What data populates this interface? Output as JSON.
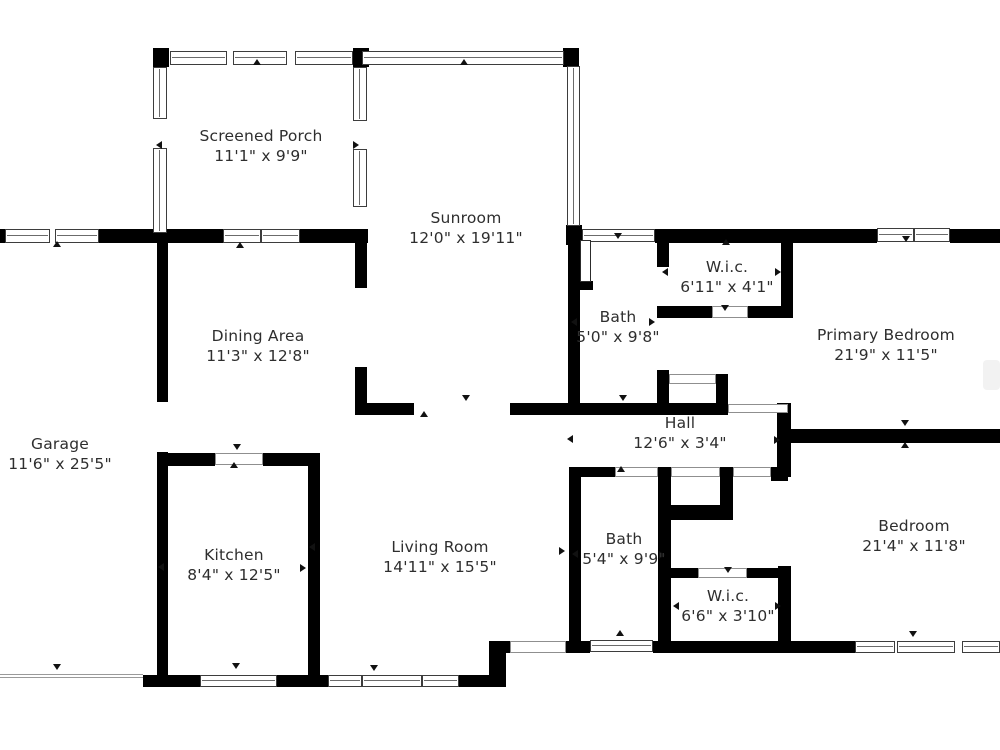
{
  "title": "Floor Plan",
  "colors": {
    "background": "#ffffff",
    "wall": "#000000",
    "window_border": "#3d3d3d",
    "window_line": "#6b6b6b",
    "door_line": "#8f8f8f",
    "label_text": "#2e2e2e",
    "marker": "#111111"
  },
  "rooms": [
    {
      "name": "Screened Porch",
      "dims": "11'1\" x 9'9\"",
      "cx": 261,
      "cy": 146
    },
    {
      "name": "Sunroom",
      "dims": "12'0\" x 19'11\"",
      "cx": 466,
      "cy": 228
    },
    {
      "name": "Dining Area",
      "dims": "11'3\" x 12'8\"",
      "cx": 258,
      "cy": 346
    },
    {
      "name": "Garage",
      "dims": "11'6\" x 25'5\"",
      "cx": 60,
      "cy": 454
    },
    {
      "name": "Kitchen",
      "dims": "8'4\" x 12'5\"",
      "cx": 234,
      "cy": 565
    },
    {
      "name": "Living Room",
      "dims": "14'11\" x 15'5\"",
      "cx": 440,
      "cy": 557
    },
    {
      "name": "Bath",
      "dims": "5'0\" x 9'8\"",
      "cx": 618,
      "cy": 327
    },
    {
      "name": "W.i.c.",
      "dims": "6'11\" x 4'1\"",
      "cx": 727,
      "cy": 277
    },
    {
      "name": "Primary Bedroom",
      "dims": "21'9\" x 11'5\"",
      "cx": 886,
      "cy": 345
    },
    {
      "name": "Hall",
      "dims": "12'6\" x 3'4\"",
      "cx": 680,
      "cy": 433
    },
    {
      "name": "Bath",
      "dims": "5'4\" x 9'9\"",
      "cx": 624,
      "cy": 549
    },
    {
      "name": "W.i.c.",
      "dims": "6'6\" x 3'10\"",
      "cx": 728,
      "cy": 606
    },
    {
      "name": "Bedroom",
      "dims": "21'4\" x 11'8\"",
      "cx": 914,
      "cy": 536
    }
  ],
  "plan": {
    "walls": [
      [
        0,
        229,
        6,
        14
      ],
      [
        99,
        229,
        124,
        14
      ],
      [
        300,
        229,
        68,
        14
      ],
      [
        153,
        48,
        16,
        19
      ],
      [
        353,
        48,
        16,
        19
      ],
      [
        563,
        48,
        16,
        19
      ],
      [
        566,
        225,
        16,
        20
      ],
      [
        655,
        229,
        222,
        14
      ],
      [
        950,
        229,
        50,
        14
      ],
      [
        568,
        238,
        12,
        177
      ],
      [
        568,
        281,
        25,
        9
      ],
      [
        355,
        243,
        12,
        45
      ],
      [
        355,
        367,
        12,
        48
      ],
      [
        355,
        403,
        59,
        12
      ],
      [
        510,
        403,
        218,
        12
      ],
      [
        657,
        243,
        12,
        24
      ],
      [
        657,
        306,
        55,
        12
      ],
      [
        748,
        306,
        45,
        12
      ],
      [
        781,
        231,
        12,
        87
      ],
      [
        657,
        370,
        12,
        38
      ],
      [
        716,
        374,
        12,
        34
      ],
      [
        777,
        403,
        14,
        74
      ],
      [
        791,
        429,
        17,
        14
      ],
      [
        788,
        429,
        212,
        14
      ],
      [
        569,
        467,
        46,
        10
      ],
      [
        771,
        467,
        17,
        14
      ],
      [
        720,
        467,
        13,
        40
      ],
      [
        671,
        505,
        62,
        15
      ],
      [
        569,
        467,
        12,
        185
      ],
      [
        658,
        467,
        13,
        185
      ],
      [
        671,
        568,
        27,
        10
      ],
      [
        747,
        568,
        43,
        10
      ],
      [
        778,
        566,
        13,
        87
      ],
      [
        566,
        641,
        24,
        12
      ],
      [
        653,
        641,
        202,
        12
      ],
      [
        489,
        641,
        17,
        46
      ],
      [
        506,
        641,
        6,
        12
      ],
      [
        143,
        675,
        57,
        12
      ],
      [
        277,
        675,
        51,
        12
      ],
      [
        458,
        675,
        31,
        12
      ],
      [
        157,
        240,
        11,
        162
      ],
      [
        157,
        452,
        11,
        235
      ],
      [
        157,
        453,
        58,
        13
      ],
      [
        263,
        453,
        57,
        13
      ],
      [
        308,
        453,
        12,
        234
      ]
    ],
    "windows": [
      {
        "x": 5,
        "y": 229,
        "w": 45,
        "h": 14,
        "o": "h"
      },
      {
        "x": 55,
        "y": 229,
        "w": 44,
        "h": 14,
        "o": "h"
      },
      {
        "x": 223,
        "y": 229,
        "w": 38,
        "h": 14,
        "o": "h"
      },
      {
        "x": 261,
        "y": 229,
        "w": 39,
        "h": 14,
        "o": "h"
      },
      {
        "x": 170,
        "y": 51,
        "w": 57,
        "h": 14,
        "o": "h"
      },
      {
        "x": 233,
        "y": 51,
        "w": 54,
        "h": 14,
        "o": "h"
      },
      {
        "x": 295,
        "y": 51,
        "w": 58,
        "h": 14,
        "o": "h"
      },
      {
        "x": 362,
        "y": 51,
        "w": 202,
        "h": 14,
        "o": "h"
      },
      {
        "x": 582,
        "y": 229,
        "w": 73,
        "h": 13,
        "o": "h"
      },
      {
        "x": 877,
        "y": 228,
        "w": 37,
        "h": 14,
        "o": "h"
      },
      {
        "x": 914,
        "y": 228,
        "w": 36,
        "h": 14,
        "o": "h"
      },
      {
        "x": 590,
        "y": 640,
        "w": 63,
        "h": 12,
        "o": "h"
      },
      {
        "x": 855,
        "y": 641,
        "w": 40,
        "h": 12,
        "o": "h"
      },
      {
        "x": 897,
        "y": 641,
        "w": 58,
        "h": 12,
        "o": "h"
      },
      {
        "x": 962,
        "y": 641,
        "w": 38,
        "h": 12,
        "o": "h"
      },
      {
        "x": 200,
        "y": 675,
        "w": 77,
        "h": 12,
        "o": "h"
      },
      {
        "x": 328,
        "y": 675,
        "w": 34,
        "h": 12,
        "o": "h"
      },
      {
        "x": 362,
        "y": 675,
        "w": 60,
        "h": 12,
        "o": "h"
      },
      {
        "x": 422,
        "y": 675,
        "w": 37,
        "h": 12,
        "o": "h"
      },
      {
        "x": 153,
        "y": 67,
        "w": 14,
        "h": 52,
        "o": "v"
      },
      {
        "x": 153,
        "y": 148,
        "w": 14,
        "h": 85,
        "o": "v"
      },
      {
        "x": 353,
        "y": 67,
        "w": 14,
        "h": 54,
        "o": "v"
      },
      {
        "x": 353,
        "y": 149,
        "w": 14,
        "h": 58,
        "o": "v"
      },
      {
        "x": 567,
        "y": 66,
        "w": 13,
        "h": 160,
        "o": "v"
      }
    ],
    "doors": [
      {
        "x": 215,
        "y": 453,
        "w": 48,
        "h": 12,
        "t": "door"
      },
      {
        "x": 157,
        "y": 402,
        "w": 11,
        "h": 50,
        "t": "open"
      },
      {
        "x": 414,
        "y": 404,
        "w": 96,
        "h": 10,
        "t": "open"
      },
      {
        "x": 728,
        "y": 404,
        "w": 60,
        "h": 9,
        "t": "door"
      },
      {
        "x": 615,
        "y": 467,
        "w": 43,
        "h": 10,
        "t": "door"
      },
      {
        "x": 671,
        "y": 467,
        "w": 49,
        "h": 10,
        "t": "door"
      },
      {
        "x": 733,
        "y": 467,
        "w": 38,
        "h": 10,
        "t": "door"
      },
      {
        "x": 712,
        "y": 306,
        "w": 36,
        "h": 12,
        "t": "door"
      },
      {
        "x": 657,
        "y": 267,
        "w": 12,
        "h": 39,
        "t": "open"
      },
      {
        "x": 698,
        "y": 568,
        "w": 49,
        "h": 10,
        "t": "door"
      },
      {
        "x": 510,
        "y": 641,
        "w": 56,
        "h": 12,
        "t": "door"
      },
      {
        "x": 355,
        "y": 288,
        "w": 12,
        "h": 79,
        "t": "open"
      },
      {
        "x": 669,
        "y": 374,
        "w": 47,
        "h": 10,
        "t": "door"
      }
    ],
    "leaves": [
      {
        "x": 580,
        "y": 240,
        "w": 11,
        "h": 42
      }
    ],
    "markers": [
      {
        "x": 57,
        "y": 245,
        "d": "up"
      },
      {
        "x": 240,
        "y": 246,
        "d": "up"
      },
      {
        "x": 257,
        "y": 63,
        "d": "up"
      },
      {
        "x": 464,
        "y": 63,
        "d": "up"
      },
      {
        "x": 160,
        "y": 145,
        "d": "left"
      },
      {
        "x": 357,
        "y": 145,
        "d": "right"
      },
      {
        "x": 57,
        "y": 668,
        "d": "down"
      },
      {
        "x": 237,
        "y": 448,
        "d": "down"
      },
      {
        "x": 234,
        "y": 466,
        "d": "up"
      },
      {
        "x": 236,
        "y": 667,
        "d": "down"
      },
      {
        "x": 162,
        "y": 567,
        "d": "left"
      },
      {
        "x": 304,
        "y": 568,
        "d": "right"
      },
      {
        "x": 374,
        "y": 669,
        "d": "down"
      },
      {
        "x": 313,
        "y": 547,
        "d": "left"
      },
      {
        "x": 563,
        "y": 551,
        "d": "right"
      },
      {
        "x": 466,
        "y": 399,
        "d": "down"
      },
      {
        "x": 424,
        "y": 415,
        "d": "up"
      },
      {
        "x": 571,
        "y": 439,
        "d": "left"
      },
      {
        "x": 778,
        "y": 440,
        "d": "right"
      },
      {
        "x": 623,
        "y": 399,
        "d": "down"
      },
      {
        "x": 575,
        "y": 322,
        "d": "left"
      },
      {
        "x": 653,
        "y": 322,
        "d": "right"
      },
      {
        "x": 618,
        "y": 237,
        "d": "down"
      },
      {
        "x": 666,
        "y": 272,
        "d": "left"
      },
      {
        "x": 779,
        "y": 272,
        "d": "right"
      },
      {
        "x": 725,
        "y": 309,
        "d": "down"
      },
      {
        "x": 726,
        "y": 243,
        "d": "up"
      },
      {
        "x": 906,
        "y": 240,
        "d": "down"
      },
      {
        "x": 905,
        "y": 424,
        "d": "down"
      },
      {
        "x": 905,
        "y": 446,
        "d": "up"
      },
      {
        "x": 913,
        "y": 635,
        "d": "down"
      },
      {
        "x": 576,
        "y": 554,
        "d": "left"
      },
      {
        "x": 663,
        "y": 555,
        "d": "right"
      },
      {
        "x": 621,
        "y": 470,
        "d": "up"
      },
      {
        "x": 620,
        "y": 634,
        "d": "up"
      },
      {
        "x": 728,
        "y": 571,
        "d": "down"
      },
      {
        "x": 677,
        "y": 606,
        "d": "left"
      },
      {
        "x": 779,
        "y": 606,
        "d": "right"
      }
    ],
    "garage_door": {
      "x": 0,
      "y": 674,
      "w": 143,
      "h": 4
    },
    "watermark": {
      "x": 983,
      "y": 360,
      "w": 17,
      "h": 30
    }
  }
}
